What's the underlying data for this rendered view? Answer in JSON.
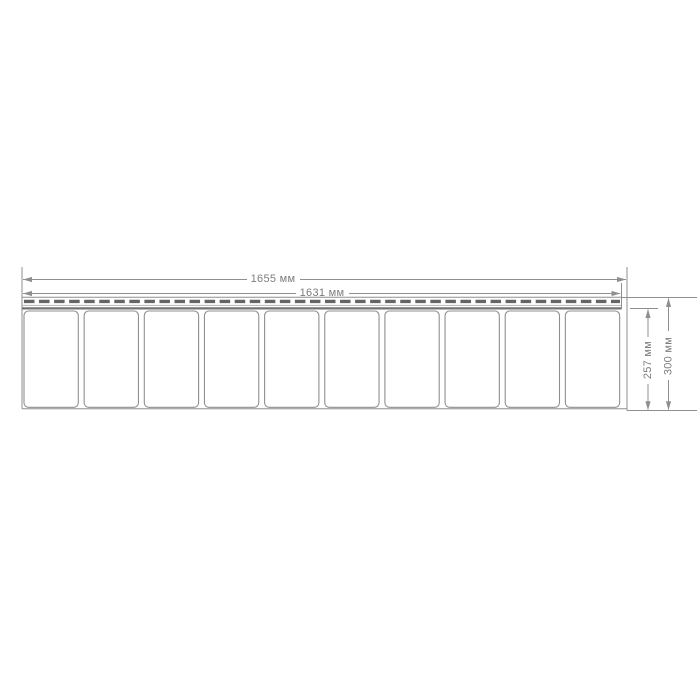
{
  "drawing": {
    "dimensions": {
      "total_length": {
        "label": "1655 мм",
        "value_mm": 1655
      },
      "working_length": {
        "label": "1631 мм",
        "value_mm": 1631
      },
      "panel_height": {
        "label": "257 мм",
        "value_mm": 257
      },
      "total_height": {
        "label": "300 мм",
        "value_mm": 300
      }
    },
    "panel": {
      "sections": 10
    }
  },
  "colors": {
    "background": "#ffffff",
    "line": "#8f8f8f",
    "line_light": "#b5b5b5",
    "strip_dark": "#737373",
    "slot": "#646464",
    "text": "#7d7d7d"
  }
}
